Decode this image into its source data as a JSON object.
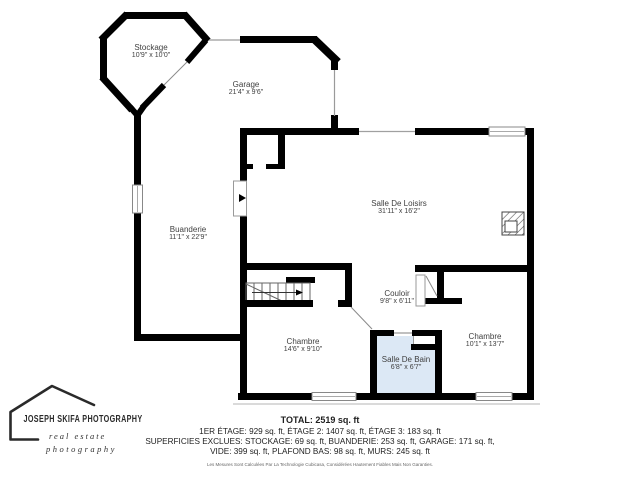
{
  "plan": {
    "rooms": {
      "stockage": {
        "name": "Stockage",
        "dims": "10'9\" x 10'0\""
      },
      "garage": {
        "name": "Garage",
        "dims": "21'4\" x 9'6\""
      },
      "buanderie": {
        "name": "Buanderie",
        "dims": "11'1\" x 22'9\""
      },
      "loisirs": {
        "name": "Salle De Loisirs",
        "dims": "31'11\" x 16'2\""
      },
      "couloir": {
        "name": "Couloir",
        "dims": "9'8\" x 6'11\""
      },
      "chambre1": {
        "name": "Chambre",
        "dims": "14'6\" x 9'10\""
      },
      "salle_de_bain": {
        "name": "Salle De Bain",
        "dims": "6'8\" x 6'7\""
      },
      "chambre2": {
        "name": "Chambre",
        "dims": "10'1\" x 13'7\""
      }
    }
  },
  "summary": {
    "total": "TOTAL: 2519 sq. ft",
    "line1": "1ER ÉTAGE: 929 sq. ft, ÉTAGE 2: 1407 sq. ft, ÉTAGE 3: 183 sq. ft",
    "line2": "SUPERFICIES EXCLUES: STOCKAGE: 69 sq. ft, BUANDERIE: 253 sq. ft, GARAGE: 171 sq. ft,",
    "line3": "VIDE: 399 sq. ft, PLAFOND BAS: 98 sq. ft, MURS: 245 sq. ft",
    "disclaimer": "Les Mesures Sont Calculées Par La Technologie Cubicasa, Considérées Hautement Fiables Mais Non Garanties."
  },
  "logo": {
    "name": "JOSEPH SKIFA PHOTOGRAPHY",
    "tagline1": "real estate",
    "tagline2": "photography"
  },
  "colors": {
    "wall": "#000000",
    "bathroom_fill": "#dce8f5",
    "label_text": "#3f3f3f"
  }
}
